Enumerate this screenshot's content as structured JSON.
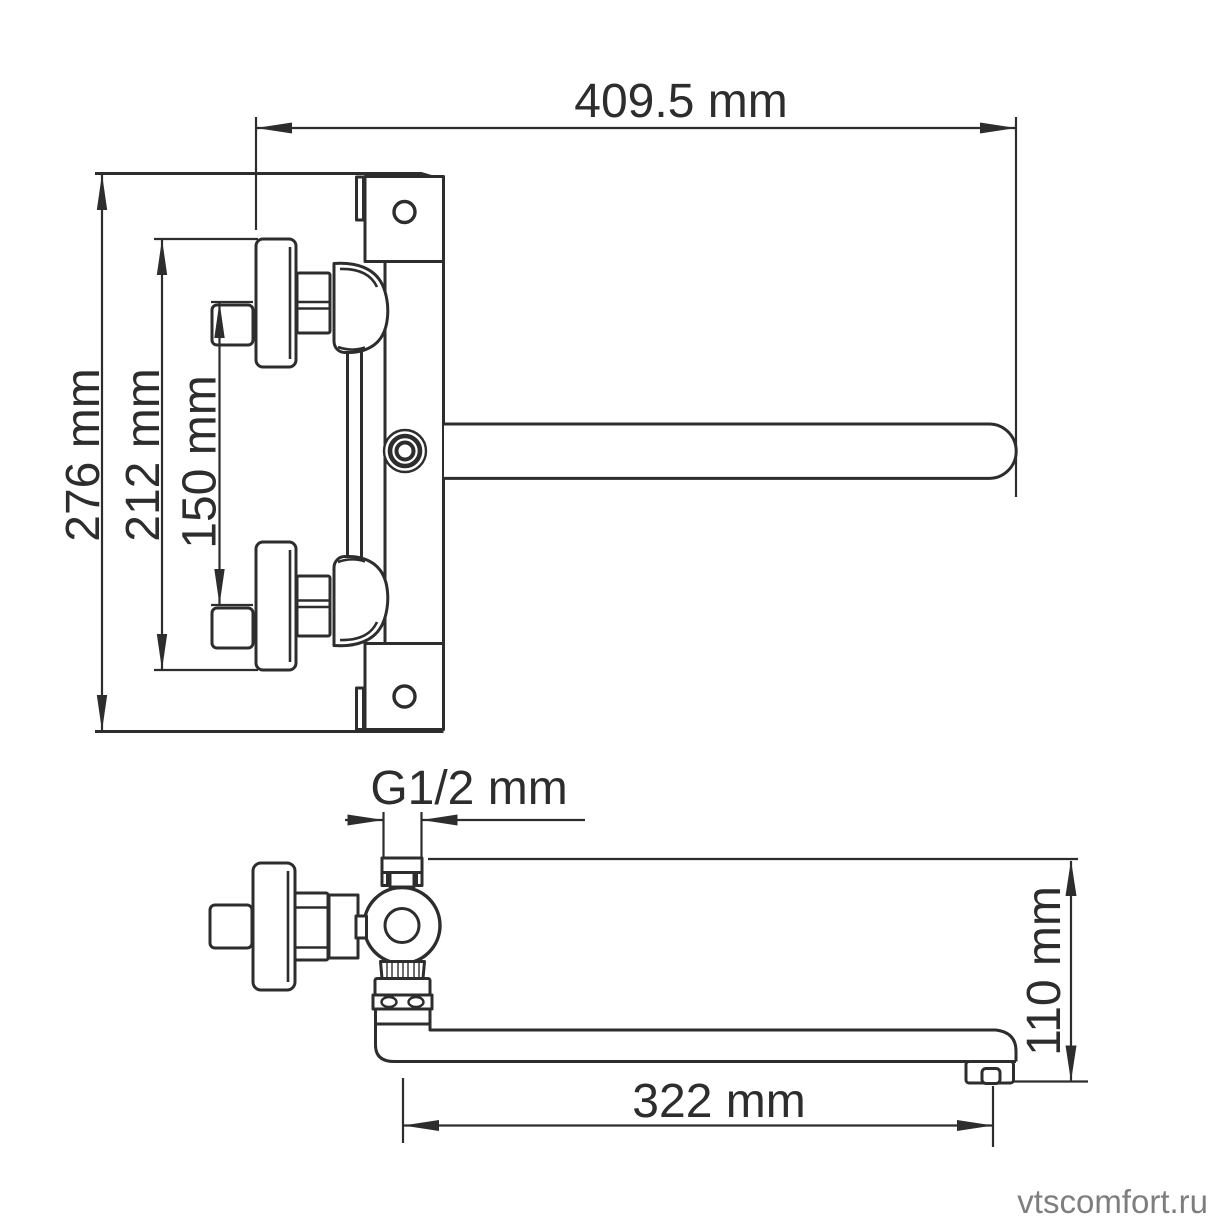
{
  "title": "faucet-dimension-drawing",
  "labels": {
    "overall_width": "409.5 mm",
    "overall_height": "276 mm",
    "handle_span": "212 mm",
    "connection_spacing": "150 mm",
    "thread_size": "G1/2 mm",
    "spout_length": "322 mm",
    "spout_height": "110 mm"
  },
  "watermark": "vtscomfort.ru",
  "colors": {
    "line": "#2d2d2d",
    "watermark": "#7e7e7e",
    "background": "#ffffff"
  }
}
